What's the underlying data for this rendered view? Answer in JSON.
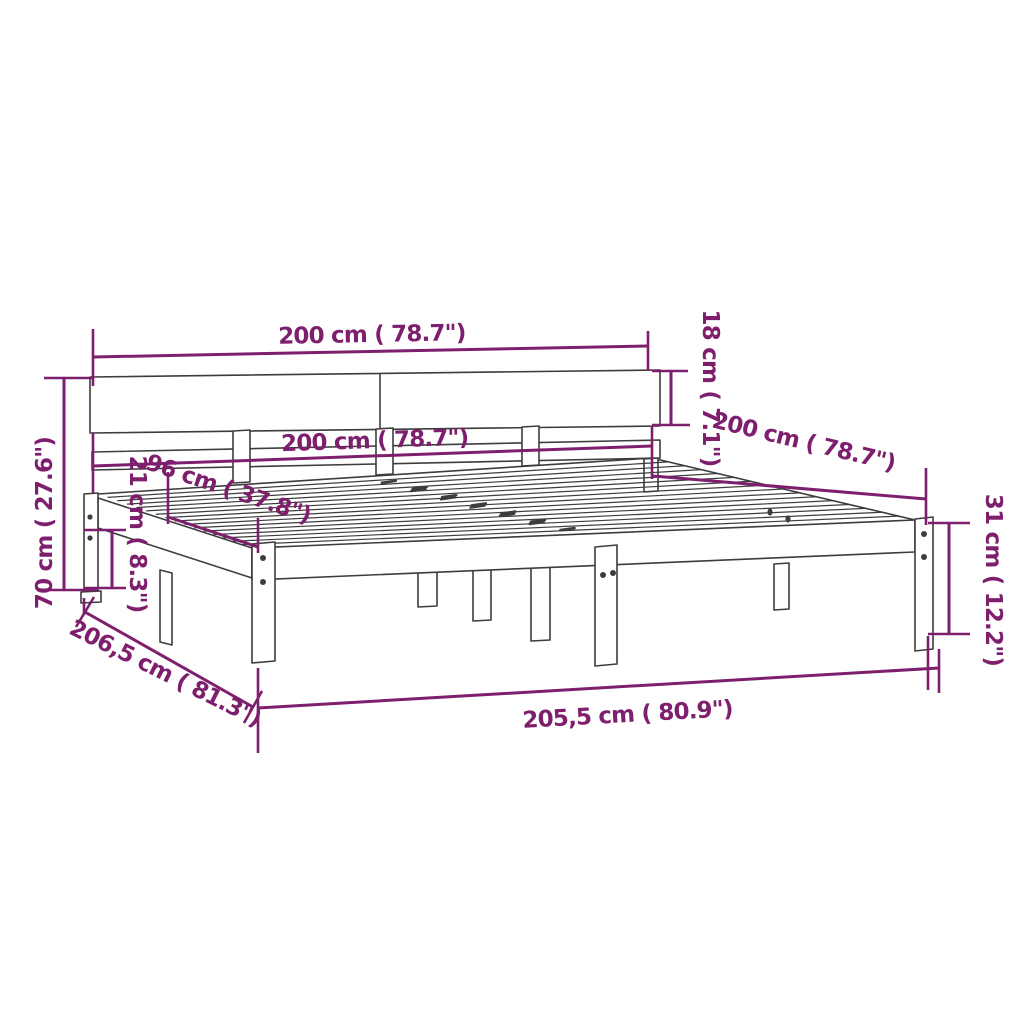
{
  "figure": {
    "type": "product-dimension-diagram",
    "subject": "bed-frame-with-headboard",
    "units": "centimeters-and-inches"
  },
  "colors": {
    "dimension": "#7e1f6e",
    "outline": "#3d3d3d",
    "background": "#ffffff"
  },
  "dimensions": {
    "headboard_width": {
      "label": "200 cm ( 78.7\")",
      "cm": "200",
      "inches": "78.7"
    },
    "headboard_board_height": {
      "label": "18 cm ( 7.1\")",
      "cm": "18",
      "inches": "7.1"
    },
    "bed_width": {
      "label": "200 cm ( 78.7\")",
      "cm": "200",
      "inches": "78.7"
    },
    "width_96": {
      "label": "96 cm ( 37.8\")",
      "cm": "96",
      "inches": "37.8"
    },
    "total_height": {
      "label": "70 cm ( 27.6\")",
      "cm": "70",
      "inches": "27.6"
    },
    "under_frame_clearance": {
      "label": "21 cm ( 8.3\")",
      "cm": "21",
      "inches": "8.3"
    },
    "bed_depth": {
      "label": "200 cm ( 78.7\")",
      "cm": "200",
      "inches": "78.7"
    },
    "frame_side_height": {
      "label": "31 cm ( 12.2\")",
      "cm": "31",
      "inches": "12.2"
    },
    "frame_length": {
      "label": "205,5 cm ( 80.9\")",
      "cm": "205,5",
      "inches": "80.9"
    },
    "frame_depth": {
      "label": "206,5 cm ( 81.3\")",
      "cm": "206,5",
      "inches": "81.3"
    }
  },
  "drawing": {
    "visible_slats": 15,
    "visible_center_marks": 12
  }
}
